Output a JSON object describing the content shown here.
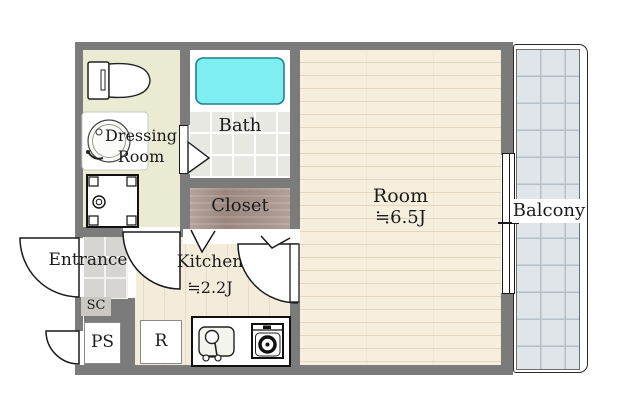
{
  "title": "Apartment floor plan",
  "labels": {
    "entrance": "Entrance",
    "dressing_line1": "Dressing",
    "dressing_line2": "Room",
    "bath": "Bath",
    "closet": "Closet",
    "room_name": "Room",
    "room_size": "≒6.5J",
    "kitchen_name": "Kitchen",
    "kitchen_size": "≒2.2J",
    "balcony": "Balcony",
    "shoe_closet": "SC",
    "pipe_space": "PS",
    "refrigerator": "R"
  },
  "icons": {
    "toilet": "toilet-icon",
    "washbasin": "washbasin-icon",
    "washing_machine_pan": "washing-machine-pan-icon",
    "bathtub": "bathtub-icon",
    "kitchen_sink": "kitchen-sink-icon",
    "stove": "stove-icon",
    "door_swing": "door-swing-arc-icon",
    "folding_door": "folding-door-icon",
    "sliding_window": "sliding-window-icon"
  },
  "colors": {
    "wall": "#7b7b7b",
    "text": "#1b1b1b",
    "dressing_floor": "#ebead3",
    "bath_tile": "#e8e8e3",
    "tub": "#7eeef0",
    "closet": "#a5928a",
    "room_floor": "#f7efde",
    "room_floor_line": "#e2d6bf",
    "kitchen_floor": "#f4ecdb",
    "kitchen_floor_line": "#e6dcc9",
    "entrance_tile": "#d7d5d2",
    "balcony_tile": "#dfe5e9",
    "balcony_tile_line": "#b5c0c8",
    "chip": "#cbc7c2"
  }
}
